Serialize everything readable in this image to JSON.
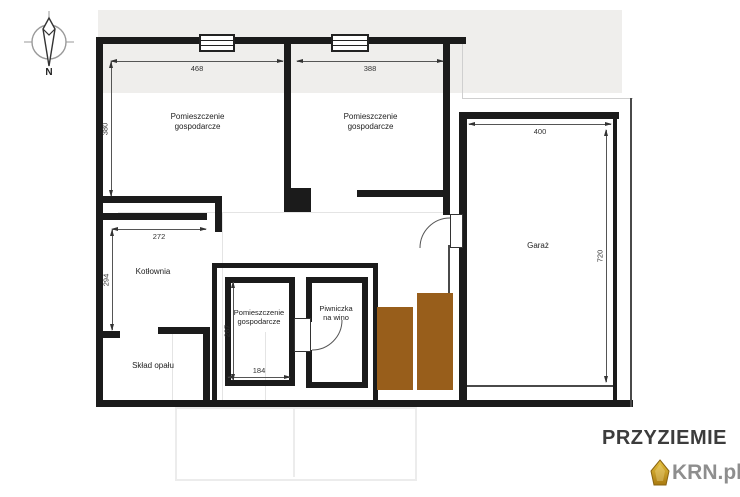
{
  "compass": {
    "north_label": "N"
  },
  "plan": {
    "rooms": {
      "utility_top_left": {
        "label": "Pomieszczenie\ngospodarcze",
        "width_cm": "468",
        "height_cm": "380"
      },
      "utility_top_mid": {
        "label": "Pomieszczenie\ngospodarcze",
        "width_cm": "388"
      },
      "garage": {
        "label": "Garaż",
        "width_cm": "400",
        "height_cm": "720"
      },
      "boiler_room": {
        "label": "Kotłownia",
        "width_cm": "272",
        "height_cm": "294"
      },
      "fuel_storage": {
        "label": "Skład opału"
      },
      "utility_bottom": {
        "label": "Pomieszczenie\ngospodarcze",
        "width_cm": "184",
        "height_cm": "287"
      },
      "wine_cellar": {
        "label": "Piwniczka\nna wino"
      }
    }
  },
  "footer": {
    "title": "PRZYZIEMIE",
    "watermark": "KRN.pl"
  },
  "colors": {
    "wall": "#1b1b1b",
    "stair_fill": "#985e1b",
    "background_block": "#efeeec",
    "gold": "#d2a62a"
  }
}
